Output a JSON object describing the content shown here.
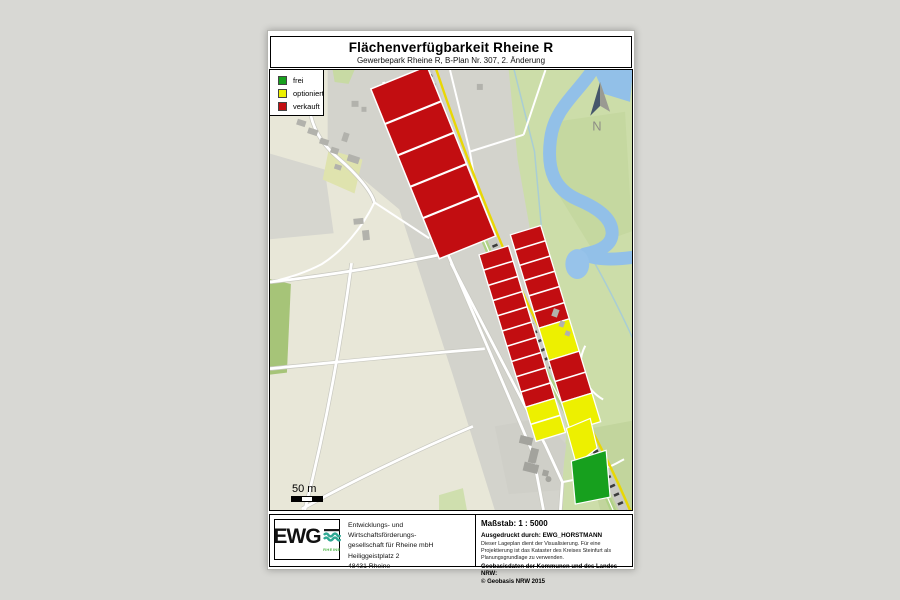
{
  "window": {
    "background": "#d8d8d4"
  },
  "document": {
    "header": {
      "title": "Flächenverfügbarkeit Rheine R",
      "subtitle": "Gewerbepark Rheine R, B-Plan Nr. 307, 2. Änderung"
    },
    "legend": {
      "items": [
        {
          "label": "frei",
          "color": "#17a01e"
        },
        {
          "label": "optioniert",
          "color": "#edf000"
        },
        {
          "label": "verkauft",
          "color": "#c20d11"
        }
      ]
    },
    "map": {
      "north_label": "N",
      "scale_bar_label": "50 m"
    },
    "footer": {
      "logo": {
        "name": "EWG",
        "subname": "RHEINE",
        "wave_color": "#2fa893",
        "subname_color": "#51b848"
      },
      "address_lines": [
        "Entwicklungs- und Wirtschaftsförderungs-",
        "gesellschaft für Rheine mbH",
        "Heiliggeistplatz 2",
        "48431 Rheine"
      ],
      "scale_text": "Maßstab: 1 : 5000",
      "printed_by": "Ausgedruckt durch: EWG_HORSTMANN",
      "disclaimer": "Dieser Lageplan dient der Visualisierung. Für eine Projektierung ist das Kataster des Kreises Steinfurt als Planungsgrundlage zu verwenden.",
      "geobasis": "Geobasisdaten der Kommunen und des Landes NRW:",
      "copyright": "© Geobasis NRW 2015"
    }
  }
}
